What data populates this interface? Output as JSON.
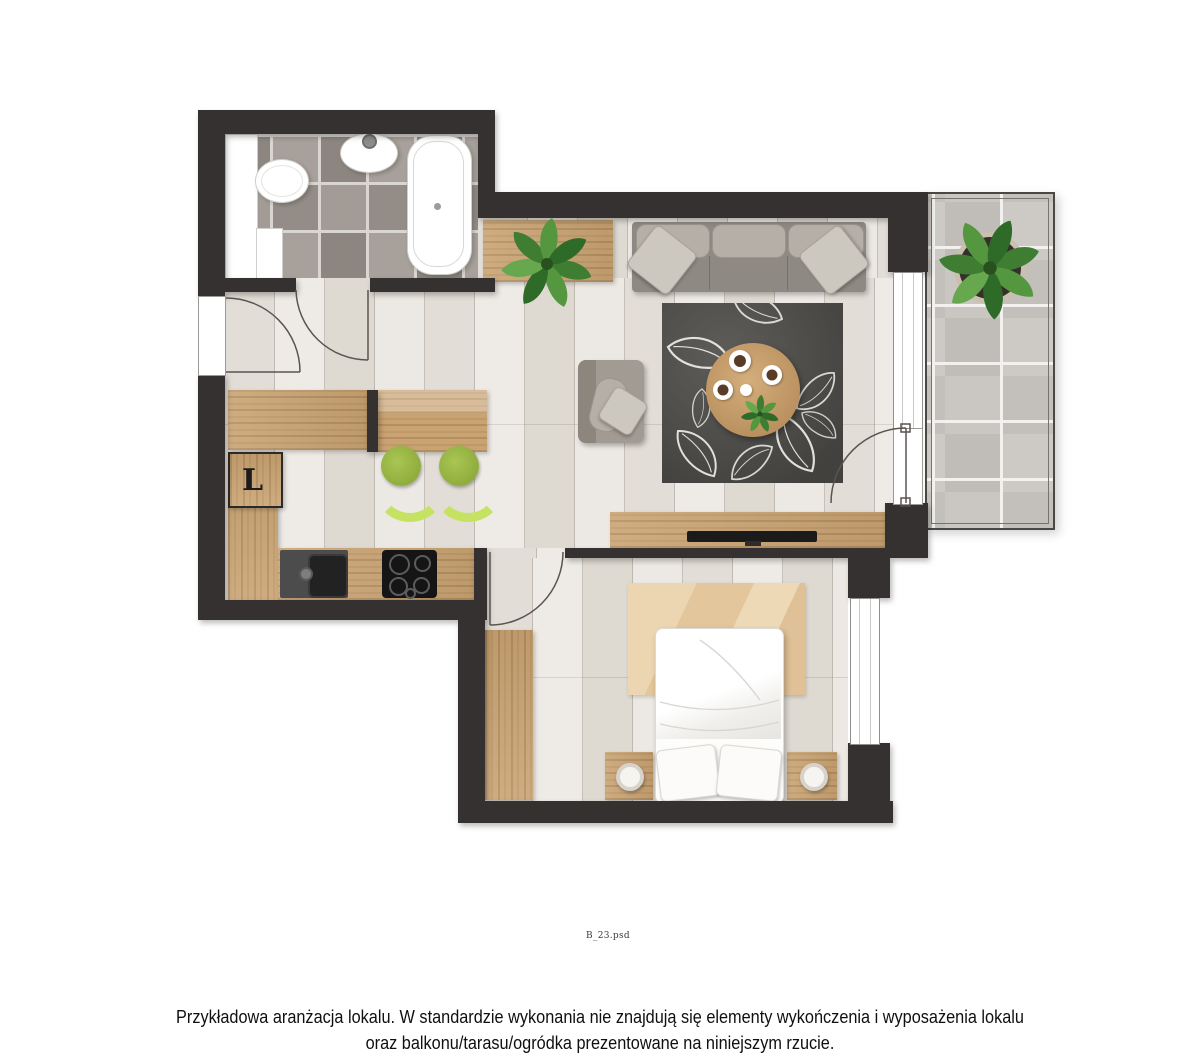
{
  "plan": {
    "kind": "apartment floor plan render",
    "fridge_label": "L",
    "file_label": "B_23.psd",
    "disclaimer": {
      "line1": "Przykładowa aranżacja lokalu. W standardzie wykonania nie znajdują się elementy wykończenia i wyposażenia lokalu",
      "line2": "oraz balkonu/tarasu/ogródka prezentowane na niniejszym rzucie."
    },
    "rooms": [
      "bathroom",
      "hallway",
      "kitchen",
      "living-room",
      "bedroom",
      "balcony"
    ],
    "colors": {
      "wall": "#353130",
      "floor": "#eae6e0",
      "wood": "#c9a372",
      "bath_tile": "#a19a94",
      "balcony_tile": "#c9c6c1",
      "grout": "#d9d6d2",
      "rug_dark": "#4e4d4a",
      "rug_beige": "#e8cfa8",
      "sofa_gray": "#8e8983",
      "stool_green": "#9ab544",
      "plant_green": "#4a8a3c",
      "fixture_white": "#ffffff",
      "text": "#101010"
    }
  }
}
